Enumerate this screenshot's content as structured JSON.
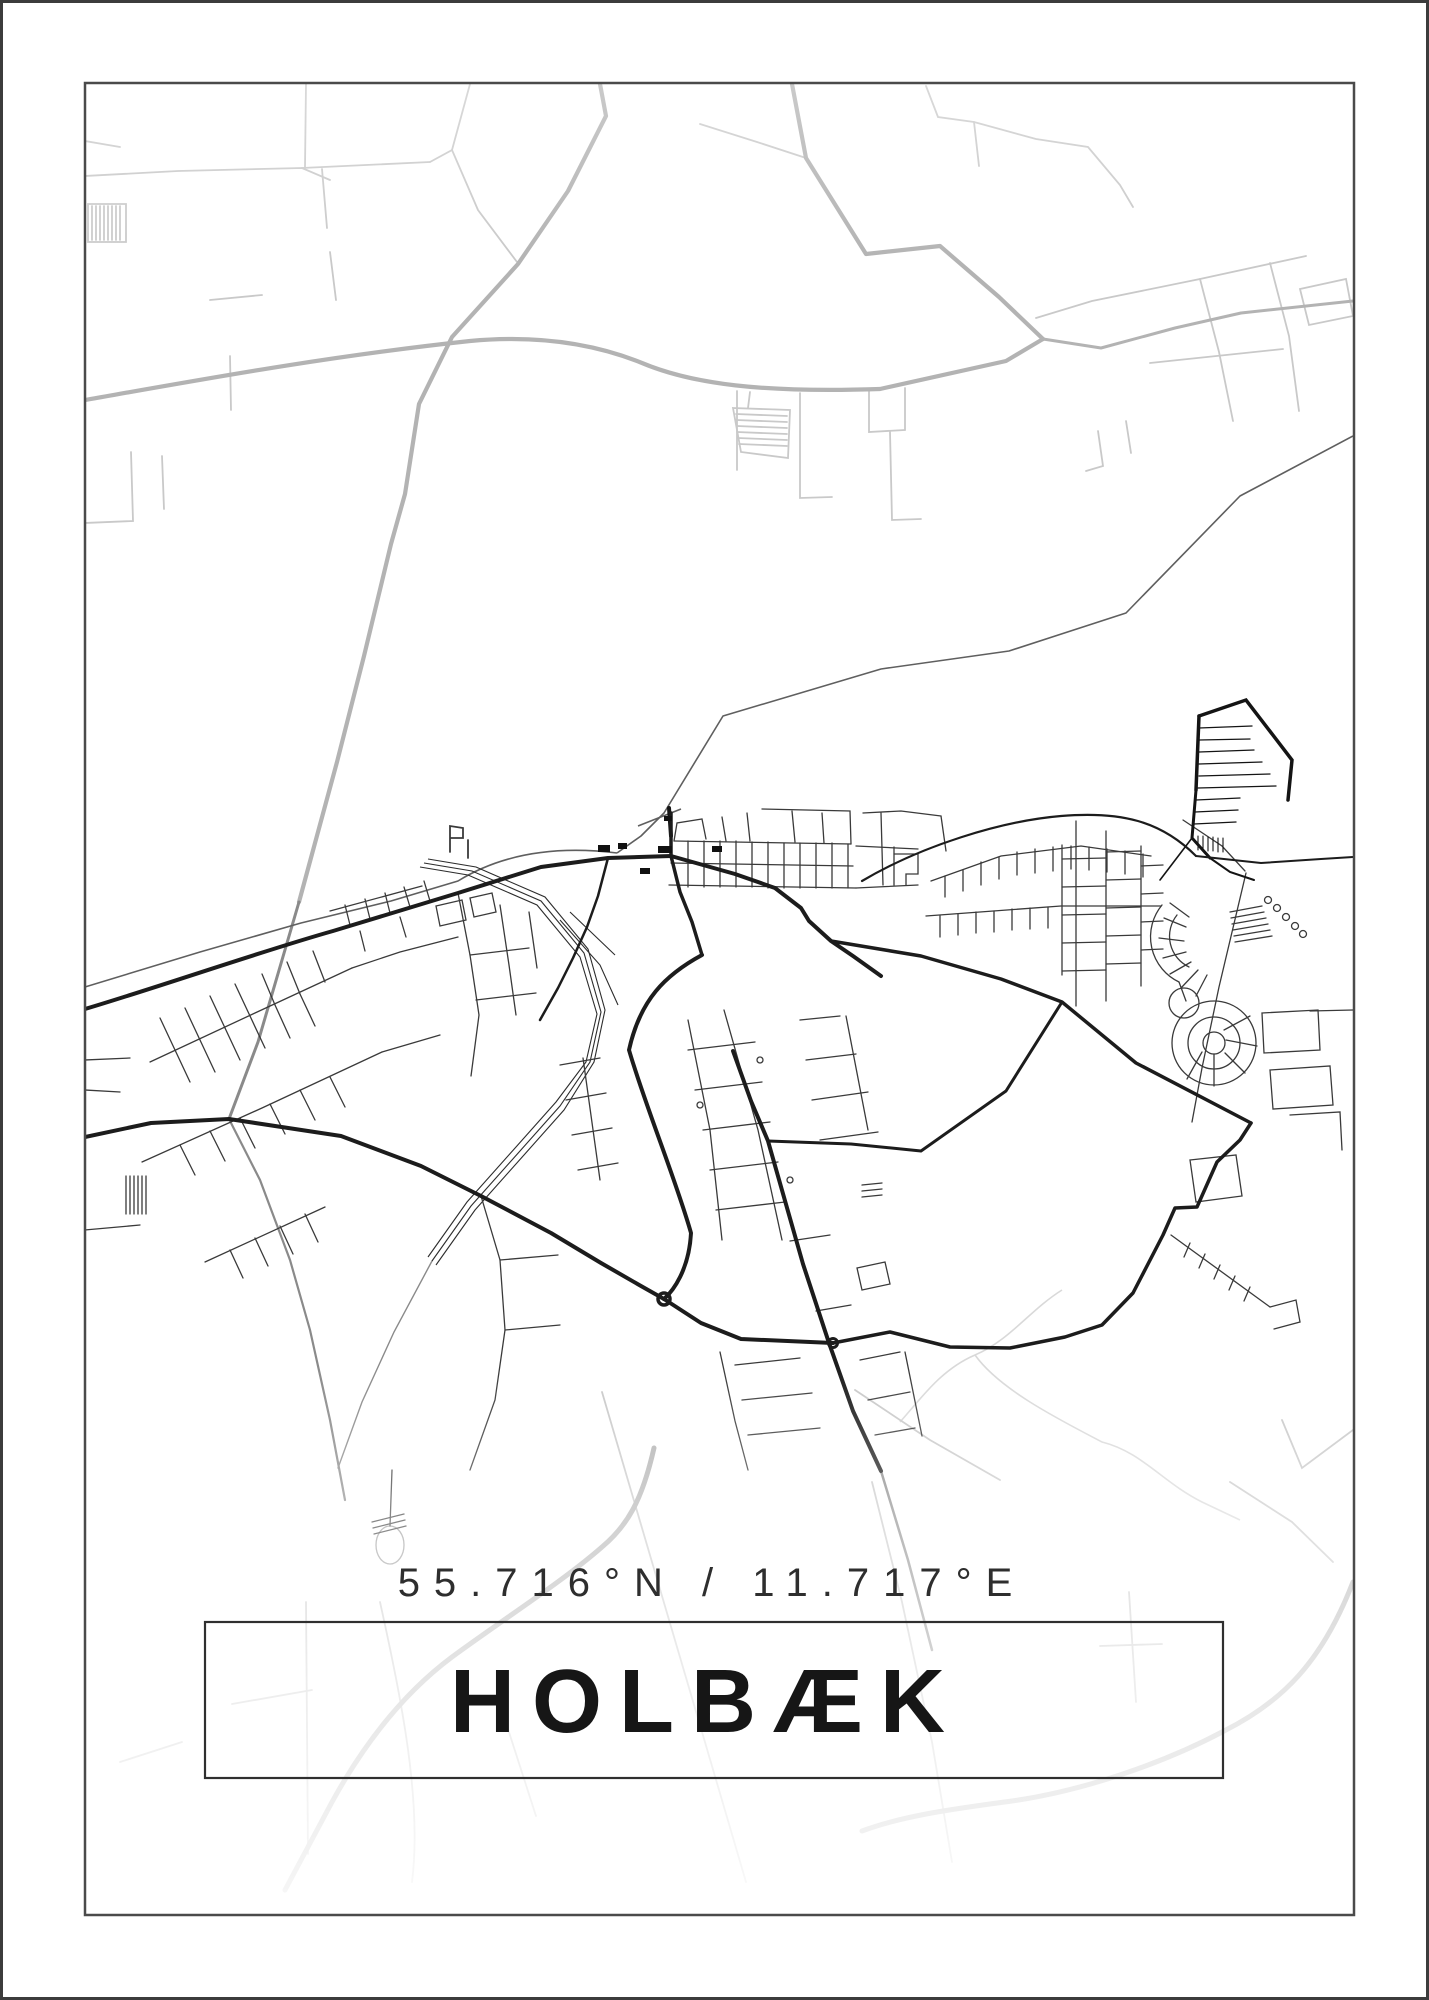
{
  "poster": {
    "title": "HOLBÆK",
    "coordinates": "55.716°N / 11.717°E",
    "colors": {
      "background": "#ffffff",
      "outer_edge": "#3c3c3c",
      "frame": "#4a4a4a",
      "title_box_border": "#2f2f2f",
      "title_text": "#161616",
      "coordinates_text": "#2e2e2e",
      "road_faint": "#d9d9d9",
      "road_light": "#c9c9c9",
      "road_medium": "#b3b3b3",
      "road_gray": "#8a8a8a",
      "coastline": "#5f5f5f",
      "road_dark": "#1c1c1c",
      "street_dark": "#3a3a3a",
      "railway": "#2c2c2c"
    }
  }
}
